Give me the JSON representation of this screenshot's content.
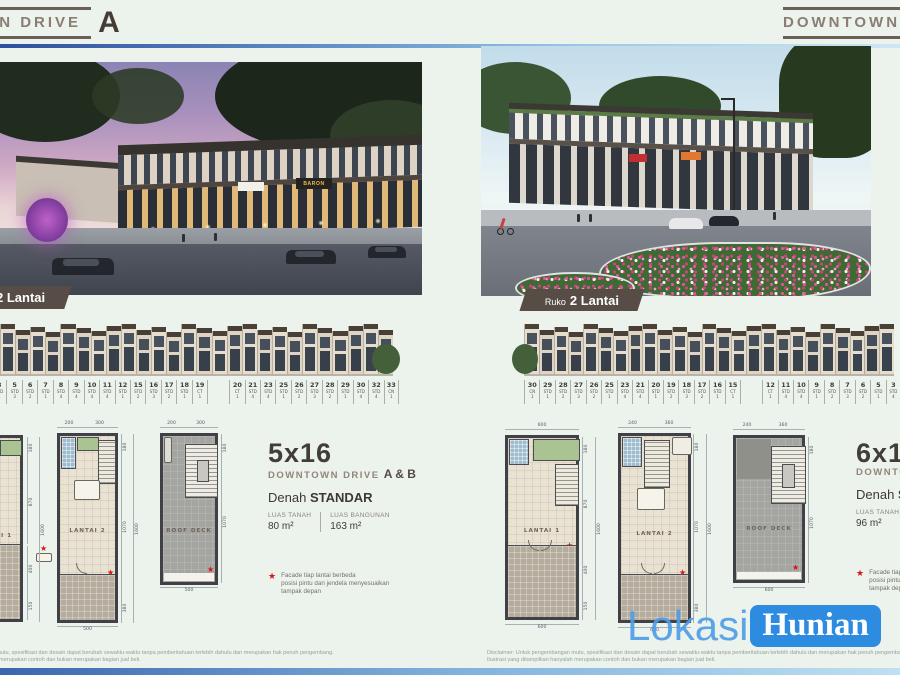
{
  "glyphs": {
    "star": "★"
  },
  "watermark": {
    "part1": "Lokasi",
    "part2": "Hunian"
  },
  "disclaimer": {
    "line1": "Disclaimer: Untuk pengembangan mutu, spesifikasi dan desain dapat berubah sewaktu-waktu tanpa pemberitahuan terlebih dahulu dan merupakan hak penuh pengembang.",
    "line2": "Ilustrasi yang ditampilkan hanyalah merupakan contoh dan bukan merupakan bagian jual beli."
  },
  "left_panel": {
    "header": {
      "title": "DOWNTOWN DRIVE",
      "block_letter": "A"
    },
    "photo": {
      "sign_label": "BARON"
    },
    "badge": {
      "prefix": "Ruko",
      "title": "2 Lantai"
    },
    "units": [
      {
        "no": "3",
        "type": "STD",
        "variant": "4"
      },
      {
        "no": "5",
        "type": "STD",
        "variant": "3"
      },
      {
        "no": "6",
        "type": "STD",
        "variant": "2"
      },
      {
        "no": "7",
        "type": "STD",
        "variant": "1"
      },
      {
        "no": "8",
        "type": "STD",
        "variant": "4"
      },
      {
        "no": "9",
        "type": "STD",
        "variant": "4"
      },
      {
        "no": "10",
        "type": "STD",
        "variant": "4"
      },
      {
        "no": "11",
        "type": "STD",
        "variant": "4"
      },
      {
        "no": "12",
        "type": "STD",
        "variant": "1"
      },
      {
        "no": "15",
        "type": "STD",
        "variant": "2"
      },
      {
        "no": "16",
        "type": "STD",
        "variant": "3"
      },
      {
        "no": "17",
        "type": "STD",
        "variant": "2"
      },
      {
        "no": "18",
        "type": "STD",
        "variant": "1"
      },
      {
        "no": "19",
        "type": "CT",
        "variant": "1"
      },
      {
        "gap": true
      },
      {
        "no": "20",
        "type": "CT",
        "variant": "1"
      },
      {
        "no": "21",
        "type": "STD",
        "variant": "4"
      },
      {
        "no": "23",
        "type": "STD",
        "variant": "4"
      },
      {
        "no": "25",
        "type": "STD",
        "variant": "1"
      },
      {
        "no": "26",
        "type": "STD",
        "variant": "2"
      },
      {
        "no": "27",
        "type": "STD",
        "variant": "3"
      },
      {
        "no": "28",
        "type": "STD",
        "variant": "2"
      },
      {
        "no": "29",
        "type": "STD",
        "variant": "1"
      },
      {
        "no": "30",
        "type": "STD",
        "variant": "4"
      },
      {
        "no": "32",
        "type": "STD",
        "variant": "4"
      },
      {
        "no": "33",
        "type": "CN",
        "variant": "1"
      }
    ],
    "plans": {
      "lantai1": {
        "label": "LANTAI 1",
        "right_dims": [
          "180",
          "870",
          "1600",
          "400",
          "150"
        ]
      },
      "lantai2": {
        "label": "LANTAI 2",
        "top_dims": [
          "200",
          "300"
        ],
        "right_dims": [
          "180",
          "1070",
          "1600",
          "380"
        ],
        "bottom_dim": "500"
      },
      "roofdeck": {
        "label": "ROOF DECK",
        "top_dims": [
          "200",
          "300"
        ],
        "right_dims": [
          "180",
          "1070"
        ],
        "bottom_dim": "500"
      }
    },
    "info": {
      "size": "5x16",
      "project": "DOWNTOWN DRIVE",
      "variant": "A & B",
      "denah_prefix": "Denah",
      "denah_value": "STANDAR",
      "lt_label": "LUAS TANAH",
      "lt_value": "80 m²",
      "lb_label": "LUAS BANGUNAN",
      "lb_value": "163 m²"
    },
    "footnote": {
      "line1": "Facade tiap lantai berbeda",
      "line2": "posisi pintu dan jendela menyesuaikan",
      "line3": "tampak depan"
    }
  },
  "right_panel": {
    "header": {
      "title": "DOWNTOWN"
    },
    "badge": {
      "prefix": "Ruko",
      "title": "2 Lantai"
    },
    "units": [
      {
        "no": "30",
        "type": "CN",
        "variant": "1"
      },
      {
        "no": "29",
        "type": "STD",
        "variant": "1"
      },
      {
        "no": "28",
        "type": "STD",
        "variant": "2"
      },
      {
        "no": "27",
        "type": "STD",
        "variant": "3"
      },
      {
        "no": "26",
        "type": "STD",
        "variant": "2"
      },
      {
        "no": "25",
        "type": "STD",
        "variant": "1"
      },
      {
        "no": "23",
        "type": "STD",
        "variant": "4"
      },
      {
        "no": "21",
        "type": "STD",
        "variant": "4"
      },
      {
        "no": "20",
        "type": "STD",
        "variant": "1"
      },
      {
        "no": "19",
        "type": "STD",
        "variant": "2"
      },
      {
        "no": "18",
        "type": "STD",
        "variant": "3"
      },
      {
        "no": "17",
        "type": "STD",
        "variant": "2"
      },
      {
        "no": "16",
        "type": "STD",
        "variant": "1"
      },
      {
        "no": "15",
        "type": "CT",
        "variant": "1"
      },
      {
        "gap": true
      },
      {
        "no": "12",
        "type": "CT",
        "variant": "1"
      },
      {
        "no": "11",
        "type": "STD",
        "variant": "4"
      },
      {
        "no": "10",
        "type": "STD",
        "variant": "4"
      },
      {
        "no": "9",
        "type": "STD",
        "variant": "1"
      },
      {
        "no": "8",
        "type": "STD",
        "variant": "2"
      },
      {
        "no": "7",
        "type": "STD",
        "variant": "3"
      },
      {
        "no": "6",
        "type": "STD",
        "variant": "2"
      },
      {
        "no": "5",
        "type": "STD",
        "variant": "1"
      },
      {
        "no": "3",
        "type": "STD",
        "variant": "4"
      }
    ],
    "plans": {
      "lantai1": {
        "label": "LANTAI 1",
        "top_dims": [
          "600"
        ],
        "right_dims": [
          "180",
          "870",
          "1600",
          "400",
          "150"
        ],
        "bottom_dim": "600"
      },
      "lantai2": {
        "label": "LANTAI 2",
        "top_dims": [
          "240",
          "360"
        ],
        "right_dims": [
          "180",
          "1070",
          "1600",
          "380"
        ],
        "bottom_dim": "600"
      },
      "roofdeck": {
        "label": "ROOF DECK",
        "top_dims": [
          "240",
          "360"
        ],
        "right_dims": [
          "180",
          "1070"
        ],
        "bottom_dim": "600"
      }
    },
    "info": {
      "size": "6x16",
      "project": "DOWNTOWN DRIVE",
      "denah_prefix": "Denah",
      "denah_value": "STANDAR",
      "lt_label": "LUAS TANAH",
      "lt_value": "96 m²"
    },
    "footnote": {
      "line1": "Facade tiap lantai berbeda",
      "line2": "posisi pintu dan jendela menyesuaikan",
      "line3": "tampak depan"
    }
  }
}
